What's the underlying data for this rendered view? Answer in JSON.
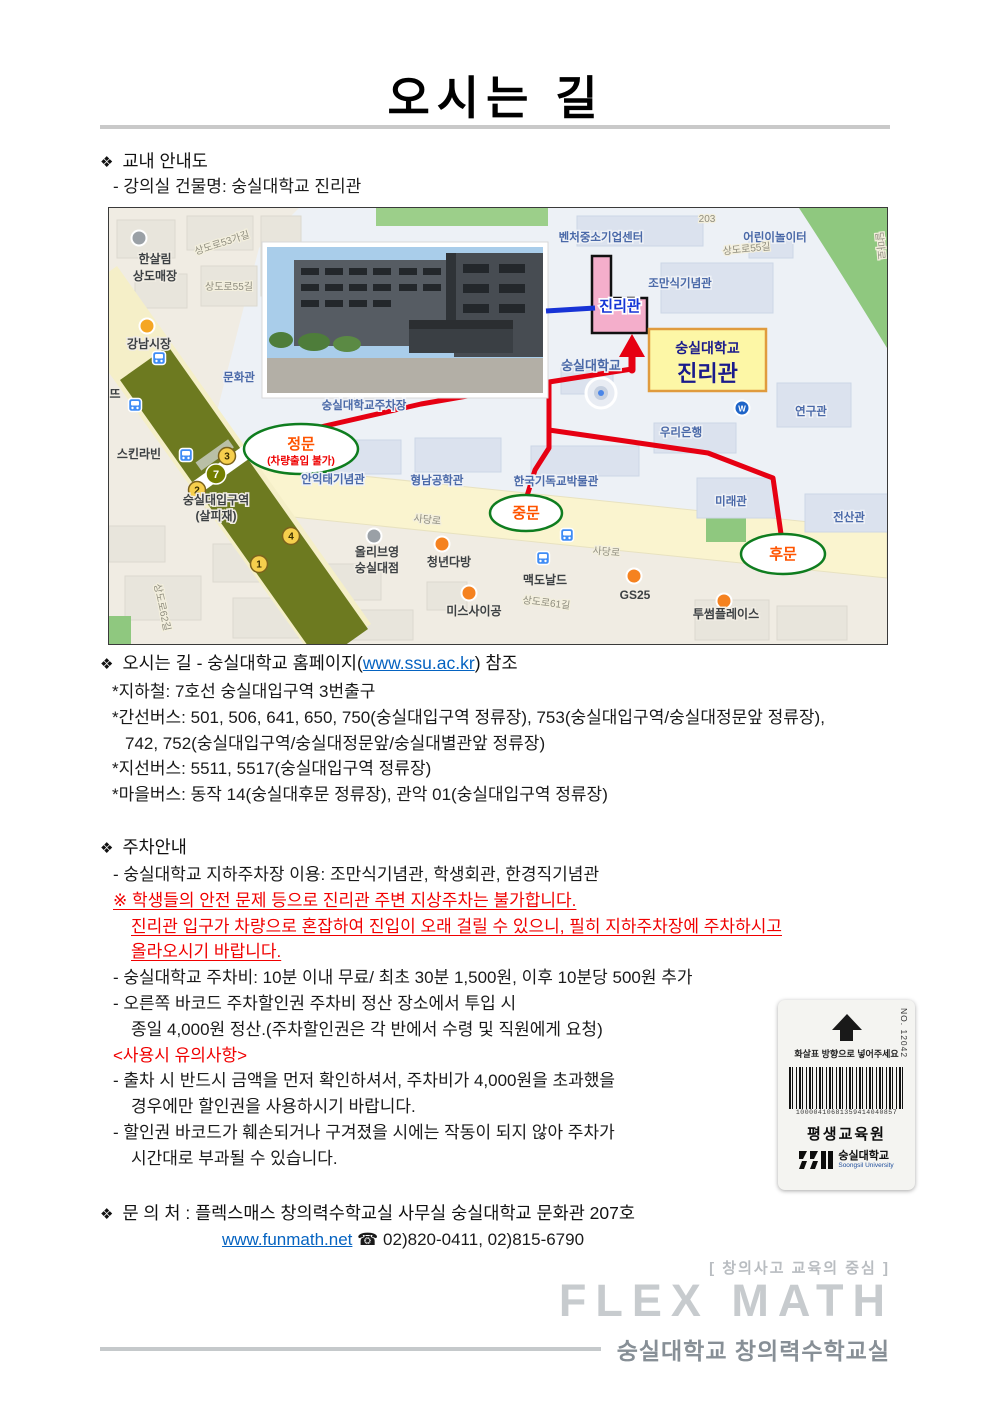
{
  "bullet": "❖",
  "title": "오시는 길",
  "campus_map": {
    "heading": "교내 안내도",
    "subheading": "- 강의실 건물명: 숭실대학교 진리관"
  },
  "directions": {
    "heading_prefix": "오시는 길 - 숭실대학교 홈페이지(",
    "link": "www.ssu.ac.kr",
    "heading_suffix": ") 참조",
    "lines": [
      {
        "t": "*지하철: 7호선 숭실대입구역 3번출구",
        "ind": 0
      },
      {
        "t": "*간선버스: 501, 506, 641, 650, 750(숭실대입구역 정류장), 753(숭실대입구역/숭실대정문앞 정류장),",
        "ind": 0
      },
      {
        "t": "742, 752(숭실대입구역/숭실대정문앞/숭실대별관앞 정류장)",
        "ind": 1
      },
      {
        "t": "*지선버스: 5511, 5517(숭실대입구역 정류장)",
        "ind": 0
      },
      {
        "t": "*마을버스: 동작 14(숭실대후문 정류장), 관악 01(숭실대입구역 정류장)",
        "ind": 0
      }
    ]
  },
  "parking": {
    "heading": "주차안내",
    "items": [
      {
        "t": "- 숭실대학교 지하주차장 이용: 조만식기념관, 학생회관, 한경직기념관",
        "st": "n",
        "ind": 1
      },
      {
        "t": "※ 학생들의 안전 문제 등으로 진리관 주변 지상주차는 불가합니다.",
        "st": "red",
        "ind": 1
      },
      {
        "t": "진리관 입구가 차량으로 혼잡하여 진입이 오래 걸릴 수 있으니, 필히 지하주차장에 주차하시고",
        "st": "red",
        "ind": 2
      },
      {
        "t": "올라오시기 바랍니다.",
        "st": "red",
        "ind": 2
      },
      {
        "t": "- 숭실대학교 주차비: 10분 이내 무료/ 최초 30분 1,500원, 이후 10분당 500원 추가",
        "st": "n",
        "ind": 1
      },
      {
        "t": "- 오른쪽 바코드 주차할인권 주차비 정산 장소에서 투입 시",
        "st": "n",
        "ind": 1
      },
      {
        "t": "종일 4,000원 정산.(주차할인권은 각 반에서 수령 및 직원에게 요청)",
        "st": "n",
        "ind": 2
      },
      {
        "t": "<사용시 유의사항>",
        "st": "redtitle",
        "ind": 1
      },
      {
        "t": "- 출차 시 반드시 금액을 먼저 확인하셔서, 주차비가 4,000원을 초과했을",
        "st": "n",
        "ind": 1
      },
      {
        "t": "경우에만 할인권을 사용하시기 바랍니다.",
        "st": "n",
        "ind": 2
      },
      {
        "t": "- 할인권 바코드가 훼손되거나 구겨졌을 시에는 작동이 되지 않아 주차가",
        "st": "n",
        "ind": 1
      },
      {
        "t": "시간대로 부과될 수 있습니다.",
        "st": "n",
        "ind": 2
      }
    ]
  },
  "contact": {
    "heading": "문 의 처 : 플렉스매스 창의력수학교실 사무실 숭실대학교 문화관 207호",
    "link": "www.funmath.net",
    "phones": "☎ 02)820-0411, 02)815-6790"
  },
  "voucher": {
    "serial": "NO. 12042",
    "arrow_note": "화살표 방향으로 넣어주세요",
    "barcode_number": "10000410681359414040857",
    "org": "평생교육원",
    "university": "숭실대학교",
    "university_en": "Soongsil University"
  },
  "footer": {
    "tagline": "[ 창의사고 교육의 중심 ]",
    "brand": "FLEX MATH",
    "org": "숭실대학교 창의력수학교실"
  },
  "map": {
    "route_color": "#e60012",
    "pointer_color": "#1733d6",
    "gate_stroke": "#0f7d1f",
    "callout": {
      "x": 540,
      "y": 121,
      "w": 117,
      "h": 62,
      "line1": "숭실대학교",
      "line2": "진리관",
      "bg": "#fdf7a6",
      "border": "#e09b3d"
    },
    "gates": [
      {
        "label": "정문",
        "sub": "(차량출입 불가)",
        "x": 192,
        "y": 241,
        "rx": 57,
        "ry": 25
      },
      {
        "label": "중문",
        "x": 417,
        "y": 305,
        "rx": 36,
        "ry": 18
      },
      {
        "label": "후문",
        "x": 674,
        "y": 346,
        "rx": 42,
        "ry": 20
      }
    ],
    "badges": [
      {
        "n": "3",
        "x": 118,
        "y": 248,
        "type": "exit"
      },
      {
        "n": "7",
        "x": 107,
        "y": 266,
        "type": "line7"
      },
      {
        "n": "2",
        "x": 88,
        "y": 282,
        "type": "exit"
      },
      {
        "n": "4",
        "x": 182,
        "y": 328,
        "type": "exit"
      },
      {
        "n": "1",
        "x": 150,
        "y": 356,
        "type": "exit"
      }
    ],
    "bus_stops": [
      {
        "x": 50,
        "y": 150
      },
      {
        "x": 26,
        "y": 197
      },
      {
        "x": 77,
        "y": 247
      },
      {
        "x": 458,
        "y": 327
      },
      {
        "x": 434,
        "y": 350
      }
    ],
    "poi_icons": [
      {
        "x": 30,
        "y": 30,
        "c": "#9aa0a6"
      },
      {
        "x": 38,
        "y": 118,
        "c": "#f5a623"
      },
      {
        "x": 265,
        "y": 328,
        "c": "#9aa0a6"
      },
      {
        "x": 333,
        "y": 336,
        "c": "#f58220"
      },
      {
        "x": 360,
        "y": 385,
        "c": "#f58220"
      },
      {
        "x": 525,
        "y": 368,
        "c": "#f5821f"
      },
      {
        "x": 615,
        "y": 393,
        "c": "#f58220"
      },
      {
        "x": 633,
        "y": 200,
        "c": "#1e64c8",
        "t": "W"
      }
    ],
    "labels": [
      {
        "t": "한살림",
        "x": 46,
        "y": 55,
        "c": "p"
      },
      {
        "t": "상도매장",
        "x": 46,
        "y": 72,
        "c": "p"
      },
      {
        "t": "상도로53가길",
        "x": 114,
        "y": 38,
        "c": "r",
        "rot": -18
      },
      {
        "t": "상도로55길",
        "x": 120,
        "y": 82,
        "c": "r"
      },
      {
        "t": "강남시장",
        "x": 40,
        "y": 140,
        "c": "p"
      },
      {
        "t": "문화관",
        "x": 130,
        "y": 173,
        "c": "b"
      },
      {
        "t": "숭실대학교주차장",
        "x": 255,
        "y": 201,
        "c": "b"
      },
      {
        "t": "뜨",
        "x": 6,
        "y": 190,
        "c": "p"
      },
      {
        "t": "스킨라빈",
        "x": 30,
        "y": 250,
        "c": "p"
      },
      {
        "t": "숭실대입구역",
        "x": 107,
        "y": 296,
        "c": "p"
      },
      {
        "t": "(살피재)",
        "x": 107,
        "y": 312,
        "c": "p"
      },
      {
        "t": "상도로62길",
        "x": 50,
        "y": 400,
        "c": "r",
        "rot": 78
      },
      {
        "t": "벤처중소기업센터",
        "x": 492,
        "y": 33,
        "c": "b"
      },
      {
        "t": "203",
        "x": 598,
        "y": 14,
        "c": "r"
      },
      {
        "t": "어린이놀이터",
        "x": 666,
        "y": 33,
        "c": "b"
      },
      {
        "t": "상도로55길",
        "x": 638,
        "y": 44,
        "c": "r",
        "rot": -6
      },
      {
        "t": "달마로",
        "x": 768,
        "y": 38,
        "c": "r",
        "rot": 85
      },
      {
        "t": "조만식기념관",
        "x": 571,
        "y": 79,
        "c": "b"
      },
      {
        "t": "진리관",
        "x": 511,
        "y": 103,
        "c": "jin"
      },
      {
        "t": "숭실대학교",
        "x": 482,
        "y": 162,
        "c": "b2"
      },
      {
        "t": "연구관",
        "x": 702,
        "y": 207,
        "c": "b"
      },
      {
        "t": "우리은행",
        "x": 572,
        "y": 228,
        "c": "b"
      },
      {
        "t": "안익태기념관",
        "x": 224,
        "y": 275,
        "c": "b"
      },
      {
        "t": "형남공학관",
        "x": 328,
        "y": 276,
        "c": "b"
      },
      {
        "t": "한국기독교박물관",
        "x": 447,
        "y": 277,
        "c": "b"
      },
      {
        "t": "미래관",
        "x": 622,
        "y": 297,
        "c": "b"
      },
      {
        "t": "전산관",
        "x": 740,
        "y": 313,
        "c": "b"
      },
      {
        "t": "사당로",
        "x": 318,
        "y": 315,
        "c": "r",
        "rot": 6
      },
      {
        "t": "사당로",
        "x": 497,
        "y": 347,
        "c": "r",
        "rot": 5
      },
      {
        "t": "올리브영",
        "x": 268,
        "y": 348,
        "c": "p"
      },
      {
        "t": "숭실대점",
        "x": 268,
        "y": 364,
        "c": "p"
      },
      {
        "t": "청년다방",
        "x": 340,
        "y": 358,
        "c": "p"
      },
      {
        "t": "맥도날드",
        "x": 436,
        "y": 376,
        "c": "p"
      },
      {
        "t": "GS25",
        "x": 526,
        "y": 391,
        "c": "p"
      },
      {
        "t": "투썸플레이스",
        "x": 617,
        "y": 410,
        "c": "p"
      },
      {
        "t": "미스사이공",
        "x": 365,
        "y": 407,
        "c": "p"
      },
      {
        "t": "상도로61길",
        "x": 437,
        "y": 398,
        "c": "r",
        "rot": 7
      }
    ]
  }
}
